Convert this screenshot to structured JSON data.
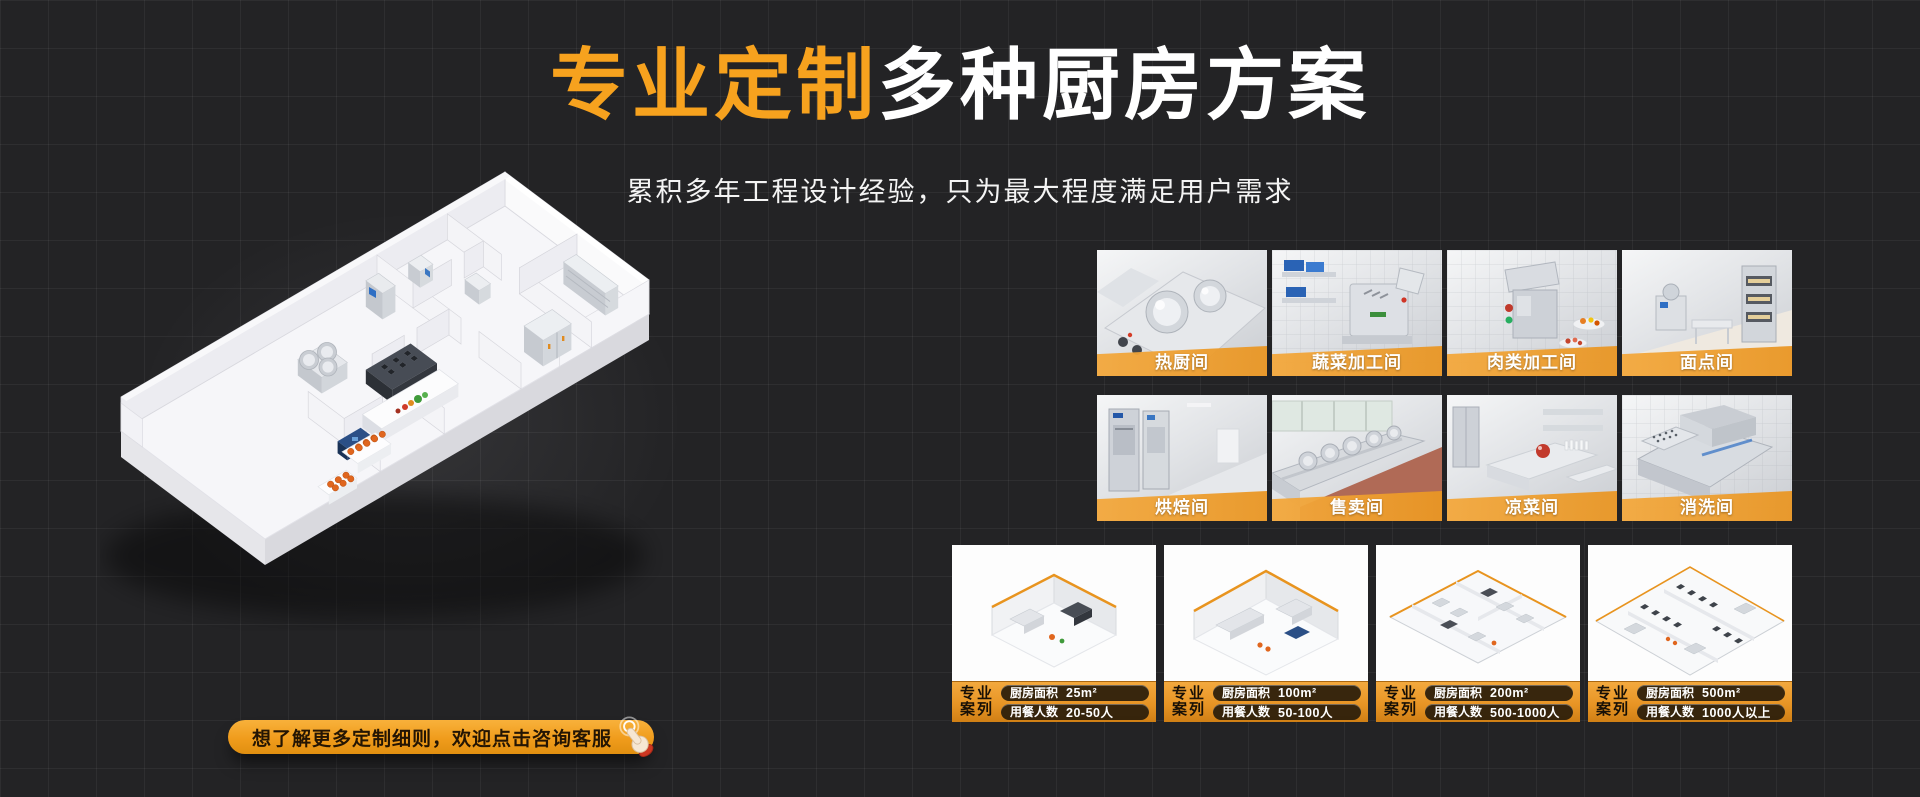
{
  "header": {
    "title_highlight": "专业定制",
    "title_rest": "多种厨房方案",
    "subtitle": "累积多年工程设计经验，只为最大程度满足用户需求"
  },
  "rooms": [
    {
      "label": "热厨间"
    },
    {
      "label": "蔬菜加工间"
    },
    {
      "label": "肉类加工间"
    },
    {
      "label": "面点间"
    },
    {
      "label": "烘焙间"
    },
    {
      "label": "售卖间"
    },
    {
      "label": "凉菜间"
    },
    {
      "label": "消洗间"
    }
  ],
  "cases": {
    "badge_line1": "专业",
    "badge_line2": "案列",
    "items": [
      {
        "area_label": "厨房面积",
        "area_value": "25m²",
        "capacity_label": "用餐人数",
        "capacity_value": "20-50人"
      },
      {
        "area_label": "厨房面积",
        "area_value": "100m²",
        "capacity_label": "用餐人数",
        "capacity_value": "50-100人"
      },
      {
        "area_label": "厨房面积",
        "area_value": "200m²",
        "capacity_label": "用餐人数",
        "capacity_value": "500-1000人"
      },
      {
        "area_label": "厨房面积",
        "area_value": "500m²",
        "capacity_label": "用餐人数",
        "capacity_value": "1000人以上"
      }
    ]
  },
  "cta": {
    "label": "想了解更多定制细则，欢迎点击咨询客服",
    "icon": "click-hand-icon"
  },
  "colors": {
    "background": "#232325",
    "accent_orange": "#F7A21E",
    "band_orange": "#EFA43F",
    "footer_orange_dark": "#D07F15",
    "pill_dark": "#2A1D0B",
    "text_light": "#FFFFFF"
  }
}
